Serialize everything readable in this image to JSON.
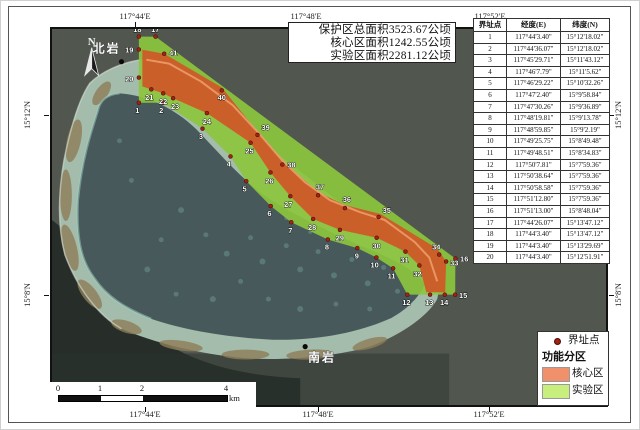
{
  "title_box": {
    "lines": [
      "保护区总面积3523.67公顷",
      "核心区面积1242.55公顷",
      "实验区面积2281.12公顷"
    ]
  },
  "axis": {
    "top": [
      "117°44'E",
      "117°48'E",
      "117°52'E"
    ],
    "bottom": [
      "117°44'E",
      "117°48'E",
      "117°52'E"
    ],
    "left": [
      "15°12'N",
      "15°8'N"
    ],
    "right": [
      "15°12'N",
      "15°8'N"
    ]
  },
  "north_arrow": {
    "label": "N"
  },
  "places": {
    "north_rock": "北岩",
    "south_rock": "南岩"
  },
  "scalebar": {
    "ticks": [
      "0",
      "1",
      "2",
      "4"
    ],
    "unit": "km"
  },
  "legend": {
    "point_label": "界址点",
    "group_title": "功能分区",
    "items": [
      {
        "label": "核心区",
        "color": "#f0916b"
      },
      {
        "label": "实验区",
        "color": "#c8ef7e"
      }
    ]
  },
  "table": {
    "headers": [
      "界址点",
      "经度(E)",
      "纬度(N)"
    ],
    "rows": [
      [
        "1",
        "117°44'3.40\"",
        "15°12'18.02\""
      ],
      [
        "2",
        "117°44'36.07\"",
        "15°12'18.02\""
      ],
      [
        "3",
        "117°45'29.71\"",
        "15°11'43.12\""
      ],
      [
        "4",
        "117°46'7.79\"",
        "15°11'5.62\""
      ],
      [
        "5",
        "117°46'29.22\"",
        "15°10'32.26\""
      ],
      [
        "6",
        "117°47'2.40\"",
        "15°9'58.84\""
      ],
      [
        "7",
        "117°47'30.26\"",
        "15°9'36.89\""
      ],
      [
        "8",
        "117°48'19.81\"",
        "15°9'13.78\""
      ],
      [
        "9",
        "117°48'59.85\"",
        "15°9'2.19\""
      ],
      [
        "10",
        "117°49'25.75\"",
        "15°8'49.48\""
      ],
      [
        "11",
        "117°49'48.51\"",
        "15°8'34.83\""
      ],
      [
        "12",
        "117°50'7.81\"",
        "15°7'59.36\""
      ],
      [
        "13",
        "117°50'38.64\"",
        "15°7'59.36\""
      ],
      [
        "14",
        "117°50'58.58\"",
        "15°7'59.36\""
      ],
      [
        "15",
        "117°51'12.80\"",
        "15°7'59.36\""
      ],
      [
        "16",
        "117°51'13.00\"",
        "15°8'48.04\""
      ],
      [
        "17",
        "117°44'26.07\"",
        "15°13'47.12\""
      ],
      [
        "18",
        "117°44'3.40\"",
        "15°13'47.12\""
      ],
      [
        "19",
        "117°44'3.40\"",
        "15°13'29.69\""
      ],
      [
        "20",
        "117°44'3.40\"",
        "15°12'51.91\""
      ]
    ]
  },
  "map": {
    "colors": {
      "core_zone": "#cf5a28",
      "experimental_zone": "#8cc63e",
      "boundary_point": "#a32112"
    },
    "points": [
      {
        "n": "1",
        "x": 137.5,
        "y": 101.5,
        "lx": 136,
        "ly": 112,
        "a": "m"
      },
      {
        "n": "2",
        "x": 161.8,
        "y": 101.5,
        "lx": 160,
        "ly": 112,
        "a": "m"
      },
      {
        "n": "3",
        "x": 201.6,
        "y": 127.7,
        "lx": 200,
        "ly": 138,
        "a": "m"
      },
      {
        "n": "4",
        "x": 229.8,
        "y": 155.8,
        "lx": 228,
        "ly": 166,
        "a": "m"
      },
      {
        "n": "5",
        "x": 245.7,
        "y": 180.8,
        "lx": 244,
        "ly": 191,
        "a": "m"
      },
      {
        "n": "6",
        "x": 270.3,
        "y": 205.9,
        "lx": 269,
        "ly": 216,
        "a": "m"
      },
      {
        "n": "7",
        "x": 291,
        "y": 222.3,
        "lx": 290,
        "ly": 233,
        "a": "m"
      },
      {
        "n": "8",
        "x": 327.8,
        "y": 239.7,
        "lx": 327,
        "ly": 250,
        "a": "m"
      },
      {
        "n": "9",
        "x": 357.5,
        "y": 248.4,
        "lx": 357,
        "ly": 259,
        "a": "m"
      },
      {
        "n": "10",
        "x": 376.7,
        "y": 257.9,
        "lx": 375,
        "ly": 268,
        "a": "m"
      },
      {
        "n": "11",
        "x": 393.6,
        "y": 268.9,
        "lx": 392,
        "ly": 279,
        "a": "m"
      },
      {
        "n": "12",
        "x": 407.9,
        "y": 295.5,
        "lx": 407,
        "ly": 306,
        "a": "m"
      },
      {
        "n": "13",
        "x": 430.8,
        "y": 295.5,
        "lx": 430,
        "ly": 306,
        "a": "m"
      },
      {
        "n": "14",
        "x": 445.6,
        "y": 295.5,
        "lx": 445,
        "ly": 306,
        "a": "m"
      },
      {
        "n": "15",
        "x": 456.1,
        "y": 295.5,
        "lx": 460,
        "ly": 299,
        "a": "s"
      },
      {
        "n": "16",
        "x": 456.3,
        "y": 259,
        "lx": 461,
        "ly": 262,
        "a": "s"
      },
      {
        "n": "17",
        "x": 154.3,
        "y": 34.7,
        "lx": 154,
        "ly": 30,
        "a": "m"
      },
      {
        "n": "18",
        "x": 137.5,
        "y": 34.7,
        "lx": 136,
        "ly": 30,
        "a": "m"
      },
      {
        "n": "19",
        "x": 137.5,
        "y": 47.7,
        "lx": 132,
        "ly": 51,
        "a": "e"
      },
      {
        "n": "20",
        "x": 137.5,
        "y": 76.1,
        "lx": 132,
        "ly": 80,
        "a": "e"
      },
      {
        "n": "21",
        "x": 150,
        "y": 88,
        "lx": 148,
        "ly": 99,
        "a": "m"
      },
      {
        "n": "22",
        "x": 162,
        "y": 92,
        "lx": 162,
        "ly": 103,
        "a": "m"
      },
      {
        "n": "23",
        "x": 172,
        "y": 97,
        "lx": 174,
        "ly": 108,
        "a": "m"
      },
      {
        "n": "24",
        "x": 206,
        "y": 112,
        "lx": 206,
        "ly": 123,
        "a": "m"
      },
      {
        "n": "25",
        "x": 250,
        "y": 142,
        "lx": 249,
        "ly": 153,
        "a": "m"
      },
      {
        "n": "26",
        "x": 270,
        "y": 172,
        "lx": 269,
        "ly": 183,
        "a": "m"
      },
      {
        "n": "27",
        "x": 290,
        "y": 196,
        "lx": 288,
        "ly": 207,
        "a": "m"
      },
      {
        "n": "28",
        "x": 313,
        "y": 219,
        "lx": 312,
        "ly": 230,
        "a": "m"
      },
      {
        "n": "29",
        "x": 340,
        "y": 230,
        "lx": 340,
        "ly": 241,
        "a": "m"
      },
      {
        "n": "30",
        "x": 377,
        "y": 238,
        "lx": 377,
        "ly": 249,
        "a": "m"
      },
      {
        "n": "31",
        "x": 406,
        "y": 252,
        "lx": 405,
        "ly": 263,
        "a": "m"
      },
      {
        "n": "32",
        "x": 420,
        "y": 266,
        "lx": 418,
        "ly": 277,
        "a": "m"
      },
      {
        "n": "33",
        "x": 447,
        "y": 262,
        "lx": 451,
        "ly": 266,
        "a": "s"
      },
      {
        "n": "34",
        "x": 440,
        "y": 255,
        "lx": 437,
        "ly": 250,
        "a": "m"
      },
      {
        "n": "35",
        "x": 379,
        "y": 217,
        "lx": 383,
        "ly": 213,
        "a": "s"
      },
      {
        "n": "36",
        "x": 345,
        "y": 208,
        "lx": 347,
        "ly": 202,
        "a": "m"
      },
      {
        "n": "37",
        "x": 318,
        "y": 195,
        "lx": 320,
        "ly": 189,
        "a": "m"
      },
      {
        "n": "38",
        "x": 282,
        "y": 164,
        "lx": 287,
        "ly": 167,
        "a": "s"
      },
      {
        "n": "39",
        "x": 257,
        "y": 134,
        "lx": 261,
        "ly": 129,
        "a": "s"
      },
      {
        "n": "40",
        "x": 221,
        "y": 89,
        "lx": 221,
        "ly": 99,
        "a": "m"
      },
      {
        "n": "41",
        "x": 163,
        "y": 52,
        "lx": 168,
        "ly": 54,
        "a": "s"
      }
    ]
  }
}
